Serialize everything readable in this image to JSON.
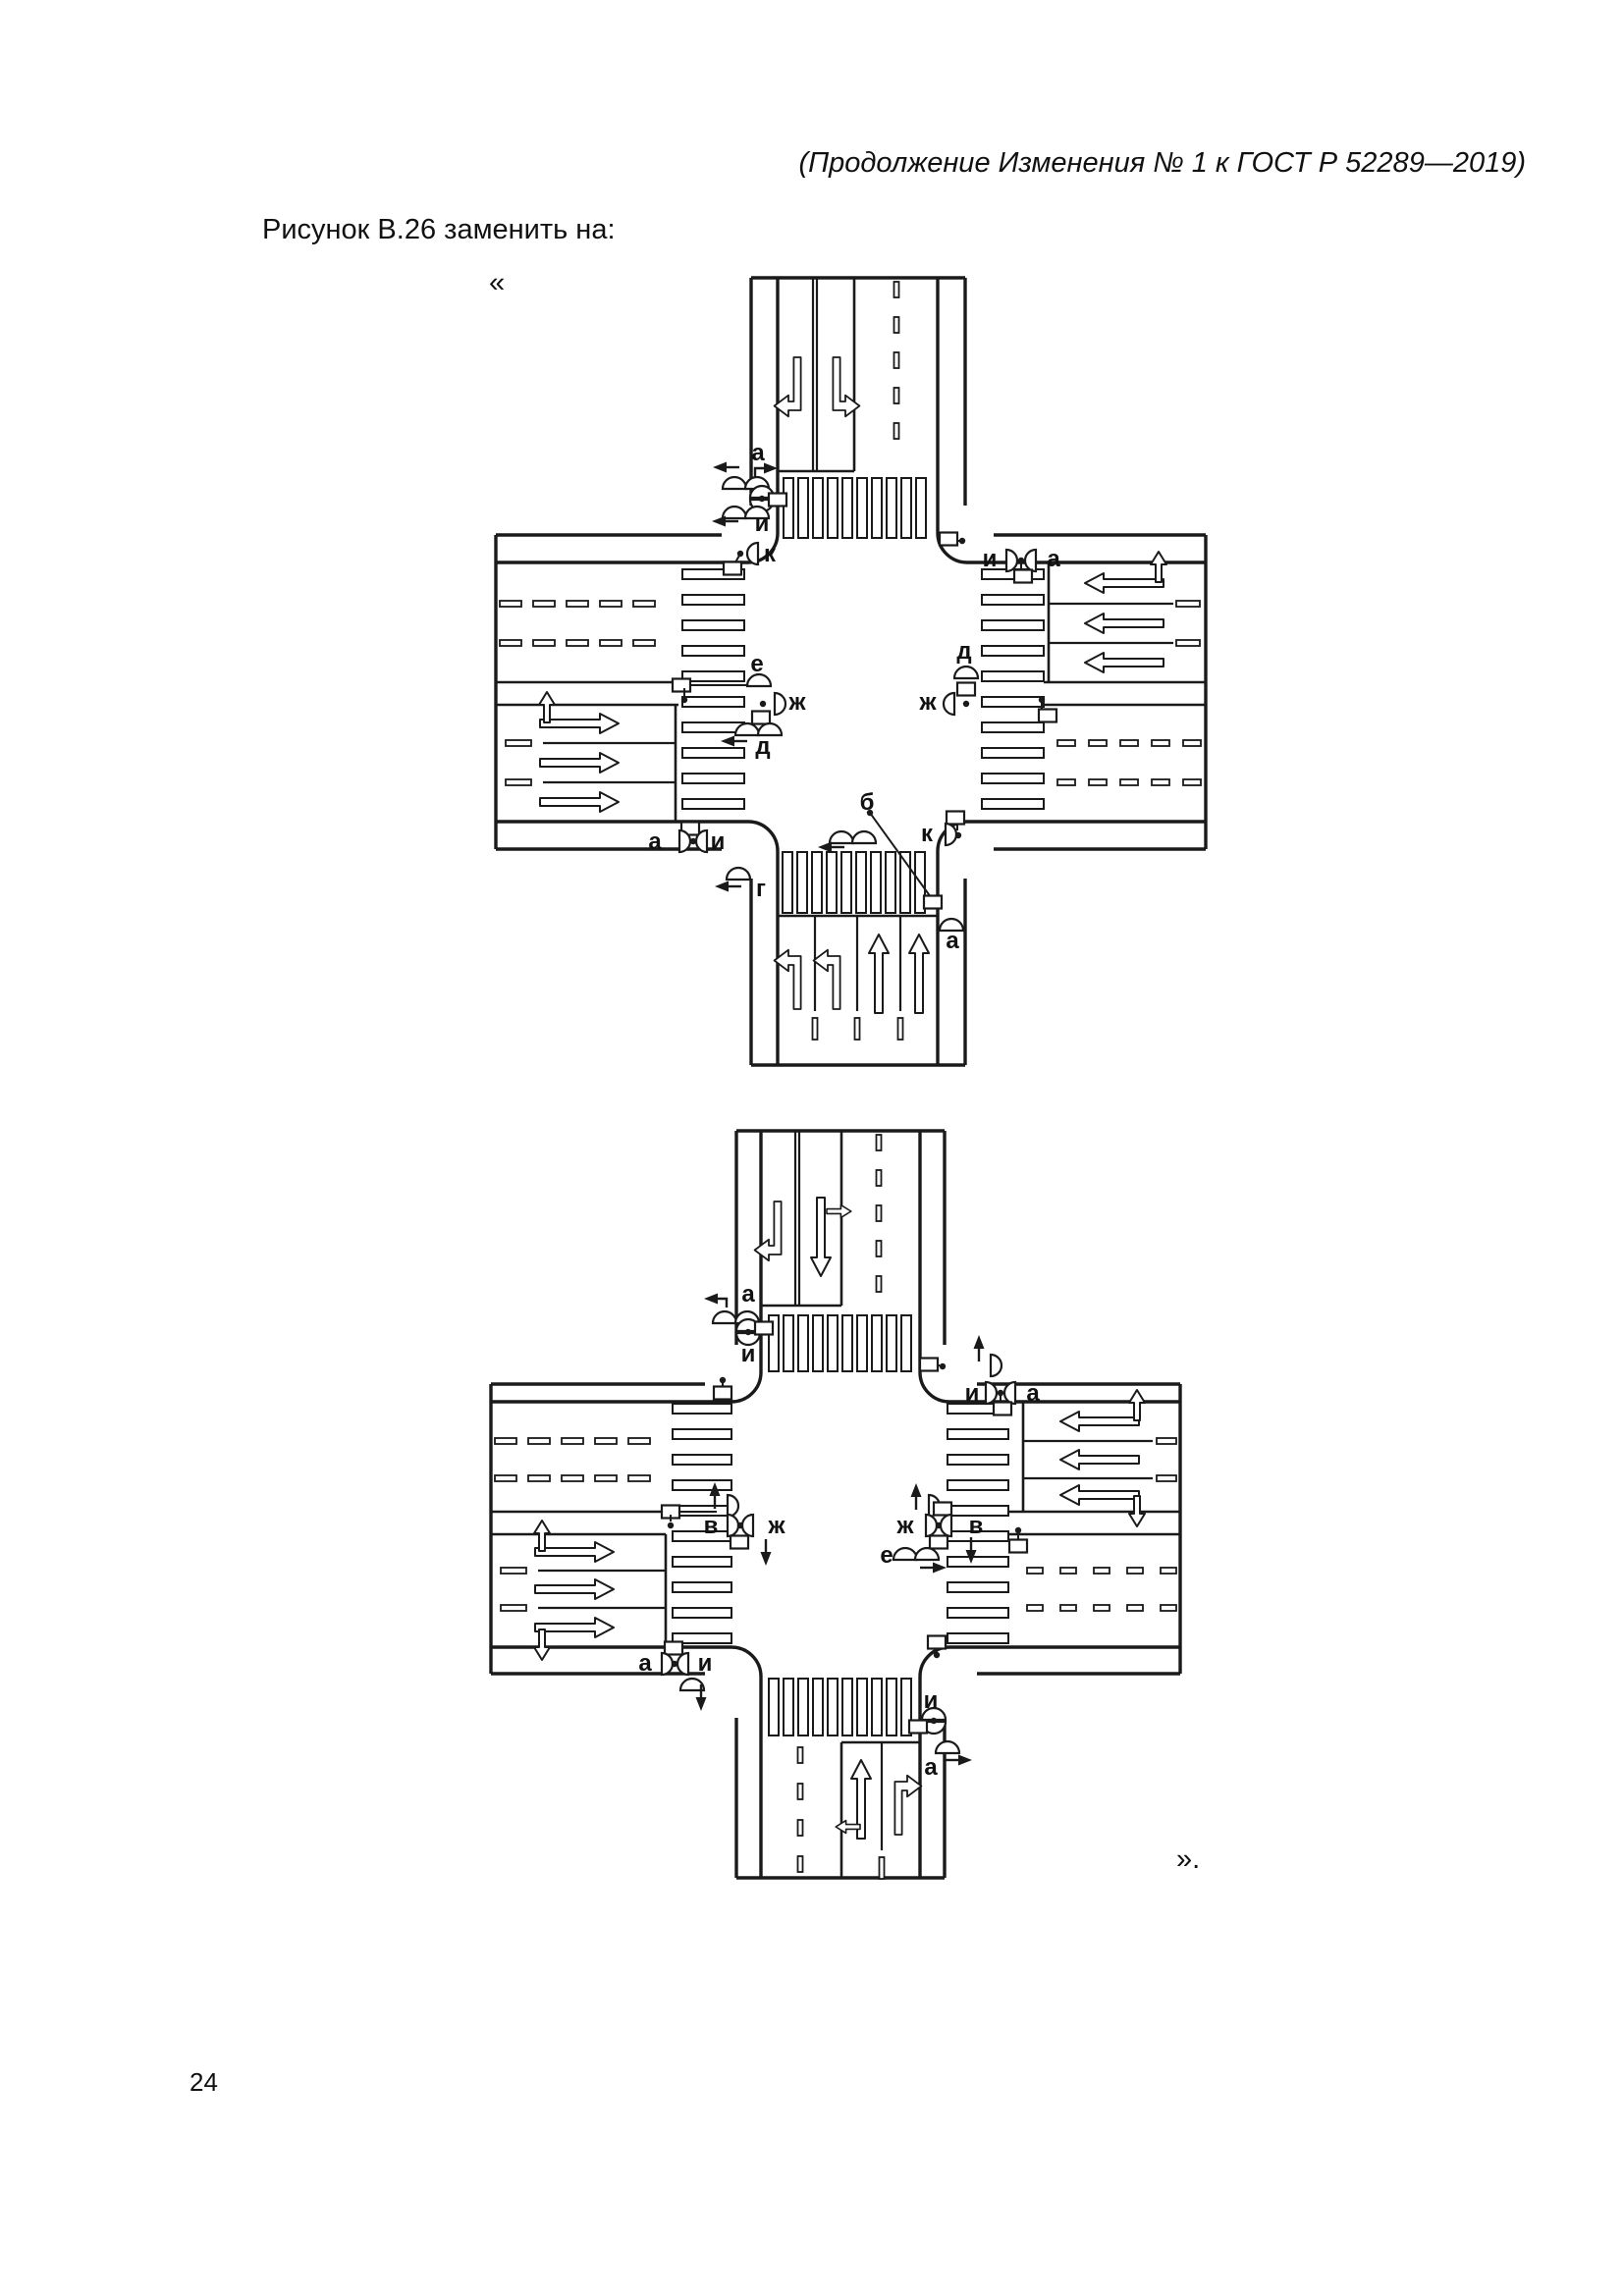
{
  "page": {
    "header_italic": "(Продолжение Изменения № 1 к ГОСТ Р 52289—2019)",
    "instruction": "Рисунок В.26 заменить на:",
    "open_quote": "«",
    "close_quote": "».",
    "page_number": "24"
  },
  "figure": {
    "diagram1": {
      "labels": {
        "north_a": "а",
        "north_i": "и",
        "north_k": "к",
        "northeast_i": "и",
        "northeast_a": "а",
        "east_d": "д",
        "east_zh": "ж",
        "west_e": "е",
        "west_zh": "ж",
        "west_d": "д",
        "southwest_a": "а",
        "southwest_i": "и",
        "south_g": "г",
        "south_b": "б",
        "southeast_k": "к",
        "southeast_a": "а"
      }
    },
    "diagram2": {
      "labels": {
        "north_a": "а",
        "north_i": "и",
        "northeast_i": "и",
        "northeast_a": "а",
        "east_zh": "ж",
        "east_v": "в",
        "east_e": "е",
        "west_v": "в",
        "west_zh": "ж",
        "southwest_a": "а",
        "southwest_i": "и",
        "south_i": "и",
        "south_a": "а"
      }
    }
  }
}
